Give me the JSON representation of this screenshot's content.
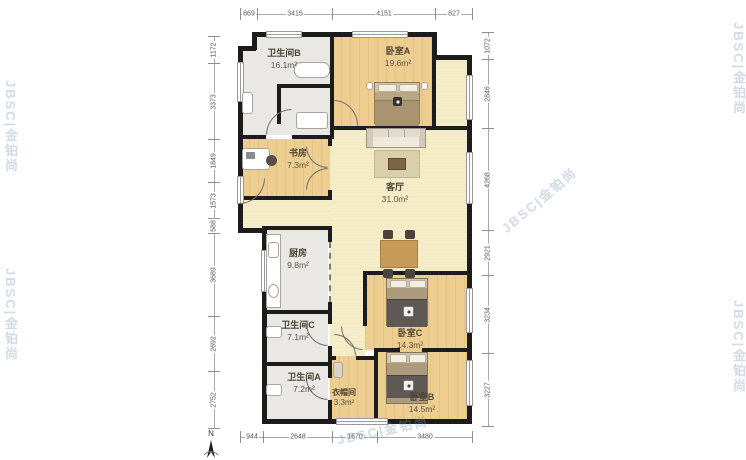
{
  "watermark": {
    "text": "JBSC|金铂尚"
  },
  "compass": {
    "north_label": "N"
  },
  "dimensions": {
    "top": [
      "869",
      "3415",
      "4151",
      "827"
    ],
    "bottom": [
      "944",
      "2648",
      "1670",
      "3480"
    ],
    "left": [
      "1172",
      "3373",
      "1849",
      "1573",
      "588",
      "3689",
      "2692",
      "2752"
    ],
    "right": [
      "1072",
      "2846",
      "4268",
      "2921",
      "3234",
      "3227"
    ]
  },
  "rooms": {
    "bathroom_b": {
      "name": "卫生间B",
      "area": "16.1m²"
    },
    "bedroom_a": {
      "name": "卧室A",
      "area": "19.6m²"
    },
    "study": {
      "name": "书房",
      "area": "7.3m²"
    },
    "living_room": {
      "name": "客厅",
      "area": "31.0m²"
    },
    "kitchen": {
      "name": "厨房",
      "area": "9.8m²"
    },
    "bathroom_c": {
      "name": "卫生间C",
      "area": "7.1m²"
    },
    "bathroom_a": {
      "name": "卫生间A",
      "area": "7.2m²"
    },
    "closet": {
      "name": "衣帽间",
      "area": "3.3m²"
    },
    "bedroom_c": {
      "name": "卧室C",
      "area": "14.3m²"
    },
    "bedroom_b": {
      "name": "卧室B",
      "area": "14.5m²"
    }
  },
  "colors": {
    "wall": "#1c1c1c",
    "floor_wood": "#eecd90",
    "floor_light": "#f4edc8",
    "floor_tile": "#eae8e4",
    "dimension_line": "#8f8f8f",
    "watermark": "#7894b6"
  }
}
